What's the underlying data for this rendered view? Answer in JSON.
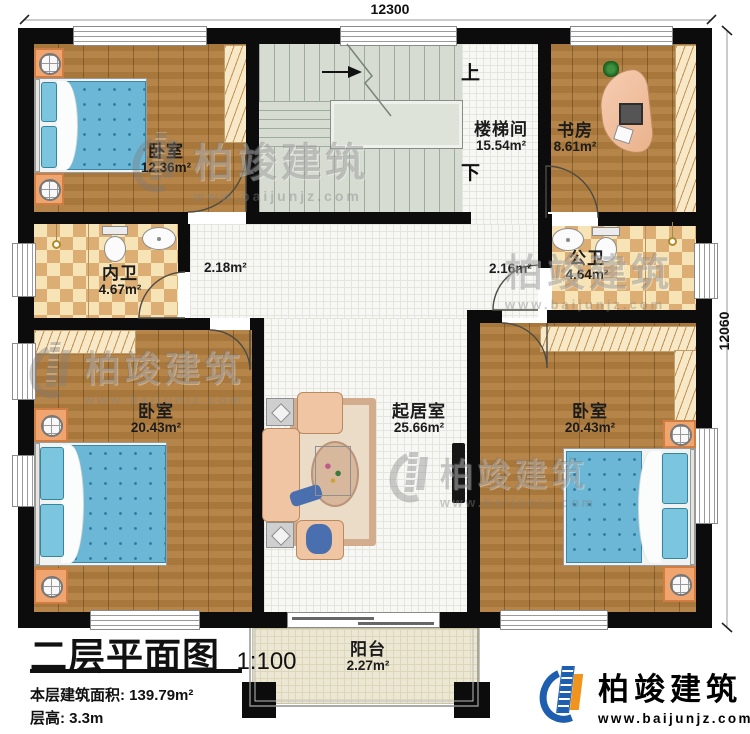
{
  "dimensions": {
    "top": "12300",
    "right": "12060"
  },
  "stairs": {
    "up": "上",
    "down": "下"
  },
  "rooms": {
    "bedroom_tl": {
      "name": "卧室",
      "area": "12.36m²"
    },
    "stairwell": {
      "name": "楼梯间",
      "area": "15.54m²"
    },
    "study": {
      "name": "书房",
      "area": "8.61m²"
    },
    "bath_inner": {
      "name": "内卫",
      "area": "4.67m²"
    },
    "hall_left": {
      "area": "2.18m²"
    },
    "hall_right": {
      "area": "2.16m²"
    },
    "bath_public": {
      "name": "公卫",
      "area": "4.64m²"
    },
    "bedroom_bl": {
      "name": "卧室",
      "area": "20.43m²"
    },
    "living": {
      "name": "起居室",
      "area": "25.66m²"
    },
    "bedroom_br": {
      "name": "卧室",
      "area": "20.43m²"
    },
    "balcony": {
      "name": "阳台",
      "area": "2.27m²"
    }
  },
  "title_block": {
    "title": "二层平面图",
    "scale": "1:100",
    "floor_area": "本层建筑面积: 139.79m²",
    "floor_height": "层高: 3.3m"
  },
  "brand": {
    "name": "柏竣建筑",
    "website": "www.baijunjz.com"
  },
  "colors": {
    "wall": "#0c0c0c",
    "wood": "#b17d3e",
    "brand_blue": "#1d5fae",
    "brand_orange": "#f0941d"
  }
}
